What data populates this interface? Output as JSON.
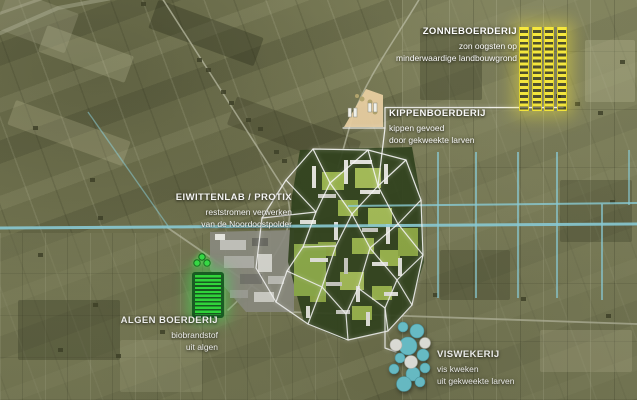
{
  "pois": {
    "zonneboerderij": {
      "title": "ZONNEBOERDERIJ",
      "lines": [
        "zon oogsten op",
        "minderwaardige landbouwgrond"
      ],
      "marker": "solar-panel-grid",
      "marker_color": "#f8ea3e"
    },
    "kippenboerderij": {
      "title": "KIPPENBOERDERIJ",
      "lines": [
        "kippen gevoed",
        "door gekweekte larven"
      ],
      "marker": "chicken-farm-plot",
      "marker_color": "#ecd2a4"
    },
    "eiwittenlab": {
      "title": "EIWITTENLAB / PROTIX",
      "lines": [
        "reststromen verwerken",
        "van de Noordoostpolder"
      ],
      "marker": "factory-area",
      "marker_color": "#8f8f86"
    },
    "algenboerderij": {
      "title": "ALGEN BOERDERIJ",
      "lines": [
        "biobrandstof",
        "uit algen"
      ],
      "marker": "algae-field",
      "marker_color": "#2fe33c"
    },
    "viswekerij": {
      "title": "VISWEKERIJ",
      "lines": [
        "vis kweken",
        "uit gekweekte larven"
      ],
      "marker": "fish-ponds",
      "marker_color": "#6cc9d6"
    }
  },
  "colors": {
    "canal": "#8ed3df",
    "network_lines": "#ffffff",
    "field_base": "#7b7d57"
  }
}
